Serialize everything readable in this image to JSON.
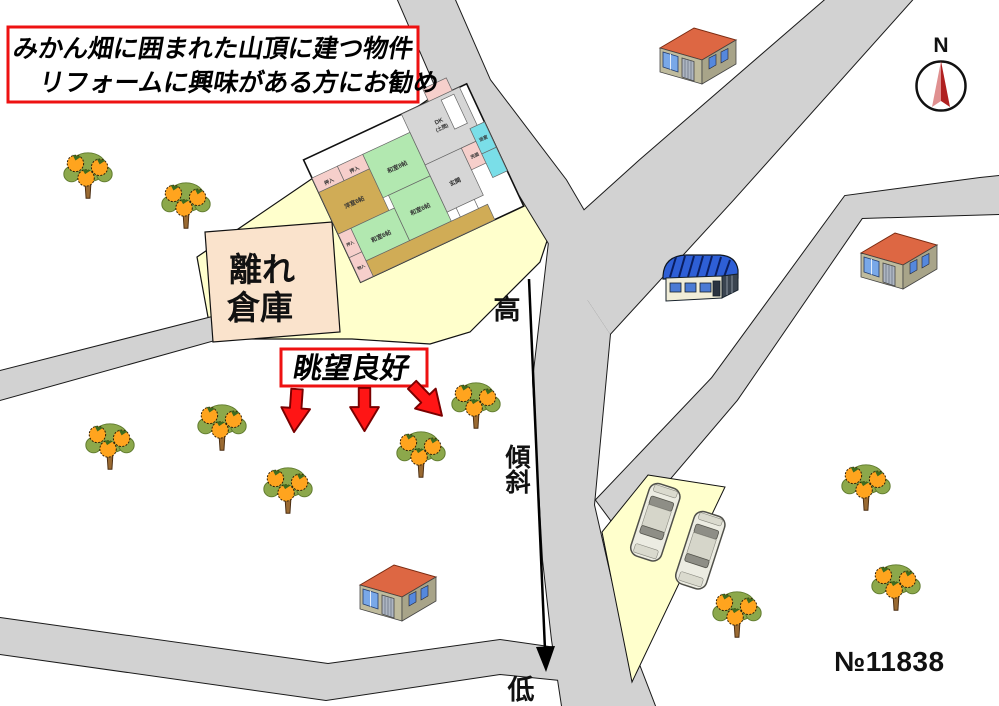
{
  "headline": {
    "line1": "みかん畑に囲まれた山頂に建つ物件",
    "line2": "リフォームに興味がある方にお勧め"
  },
  "annex": {
    "line1": "離れ",
    "line2": "倉庫"
  },
  "view_note": {
    "label": "眺望良好"
  },
  "slope": {
    "high": "高",
    "mid": "傾斜",
    "low": "低"
  },
  "compass": {
    "north": "N"
  },
  "property_number": "№11838",
  "floorplan": {
    "rooms": [
      {
        "label": "押入"
      },
      {
        "label": "押入"
      },
      {
        "label": "洋室6帖"
      },
      {
        "label": "和室8帖"
      },
      {
        "label": "和室6帖"
      },
      {
        "label": "和室6帖"
      },
      {
        "label": "DK"
      },
      {
        "label": "(土間)"
      },
      {
        "label": "玄関"
      },
      {
        "label": "押入"
      },
      {
        "label": "物入"
      },
      {
        "label": "浴室"
      },
      {
        "label": "洗面"
      }
    ]
  },
  "colors": {
    "road": "#D2D2D2",
    "parcel": "#FFFFCC",
    "annex_fill": "#FAE3CC",
    "tatami": "#B2E8B0",
    "wood": "#D0AC56",
    "closet": "#F6CFCB",
    "bath": "#7ADEE8",
    "service_gray": "#D6D6D6",
    "accent_red": "#EE1111",
    "arrow_red": "#FF1515"
  }
}
